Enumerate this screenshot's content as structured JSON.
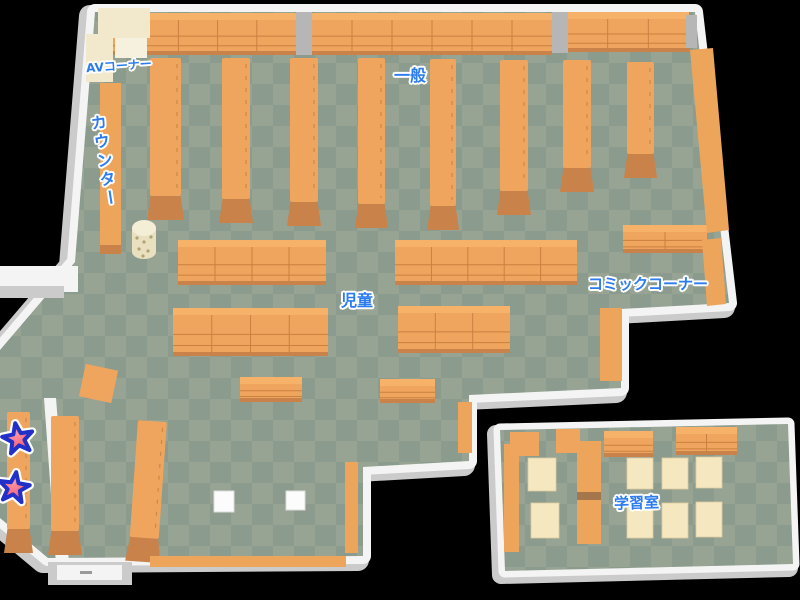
{
  "map": {
    "name": "library-floor-map",
    "areas": [
      {
        "id": "av-corner",
        "label": "AVコーナー"
      },
      {
        "id": "counter",
        "label": "カウンター"
      },
      {
        "id": "general",
        "label": "一般"
      },
      {
        "id": "children",
        "label": "児童"
      },
      {
        "id": "comic-corner",
        "label": "コミックコーナー"
      },
      {
        "id": "study-room",
        "label": "学習室"
      }
    ],
    "markers": [
      {
        "id": "star-marker-1",
        "icon": "star-icon",
        "glyph": "★"
      },
      {
        "id": "star-marker-2",
        "icon": "star-icon",
        "glyph": "★"
      }
    ],
    "colors": {
      "background": "#000000",
      "floor_light": "#97a393",
      "floor_dark": "#8b9b8d",
      "shelf": "#f0a55e",
      "shelf_dark": "#c9834a",
      "shelf_top": "#f6b269",
      "shelf_line": "#c8813f",
      "counter": "#eda55c",
      "cream": "#f2e8cb",
      "cream_light": "#f6f1de",
      "pillar": "#b6b6b6",
      "wall": "#f4f4f4",
      "wall_shadow": "#cbcbcb",
      "table": "#f5e7c0",
      "table_white": "#fcfcfc",
      "divider_gap": "#a5764b",
      "label_text": "#2b7cf0",
      "label_outline": "#ffffff",
      "star_fill": "#ee4560",
      "star_fill_light": "#fb97a5",
      "star_outline": "#2030c8"
    }
  }
}
